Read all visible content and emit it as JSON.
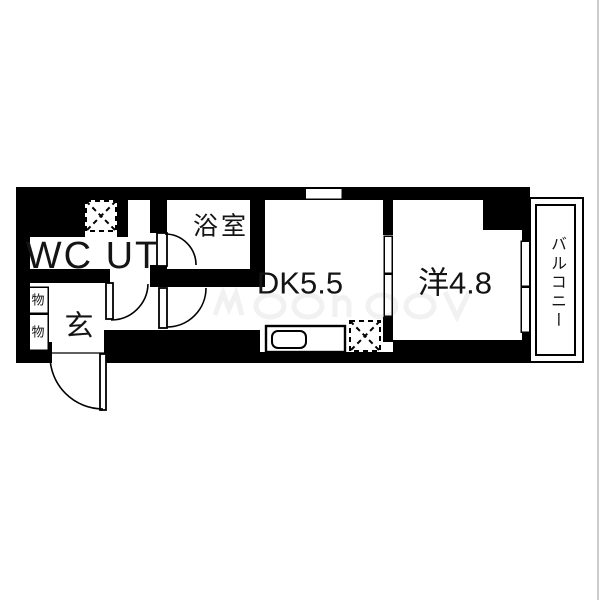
{
  "floorplan": {
    "rooms": {
      "wc_ut": {
        "label": "WC UT"
      },
      "bathroom": {
        "label": "浴室"
      },
      "dining_kitchen": {
        "label": "DK5.5"
      },
      "western_room": {
        "label": "洋4.8"
      },
      "balcony": {
        "label": "バルコニー"
      },
      "entrance": {
        "label": "玄"
      },
      "storage_upper": {
        "label": "物"
      },
      "storage_lower": {
        "label": "物"
      }
    },
    "colors": {
      "wall": "#000000",
      "floor": "#ffffff",
      "line": "#000000"
    }
  }
}
